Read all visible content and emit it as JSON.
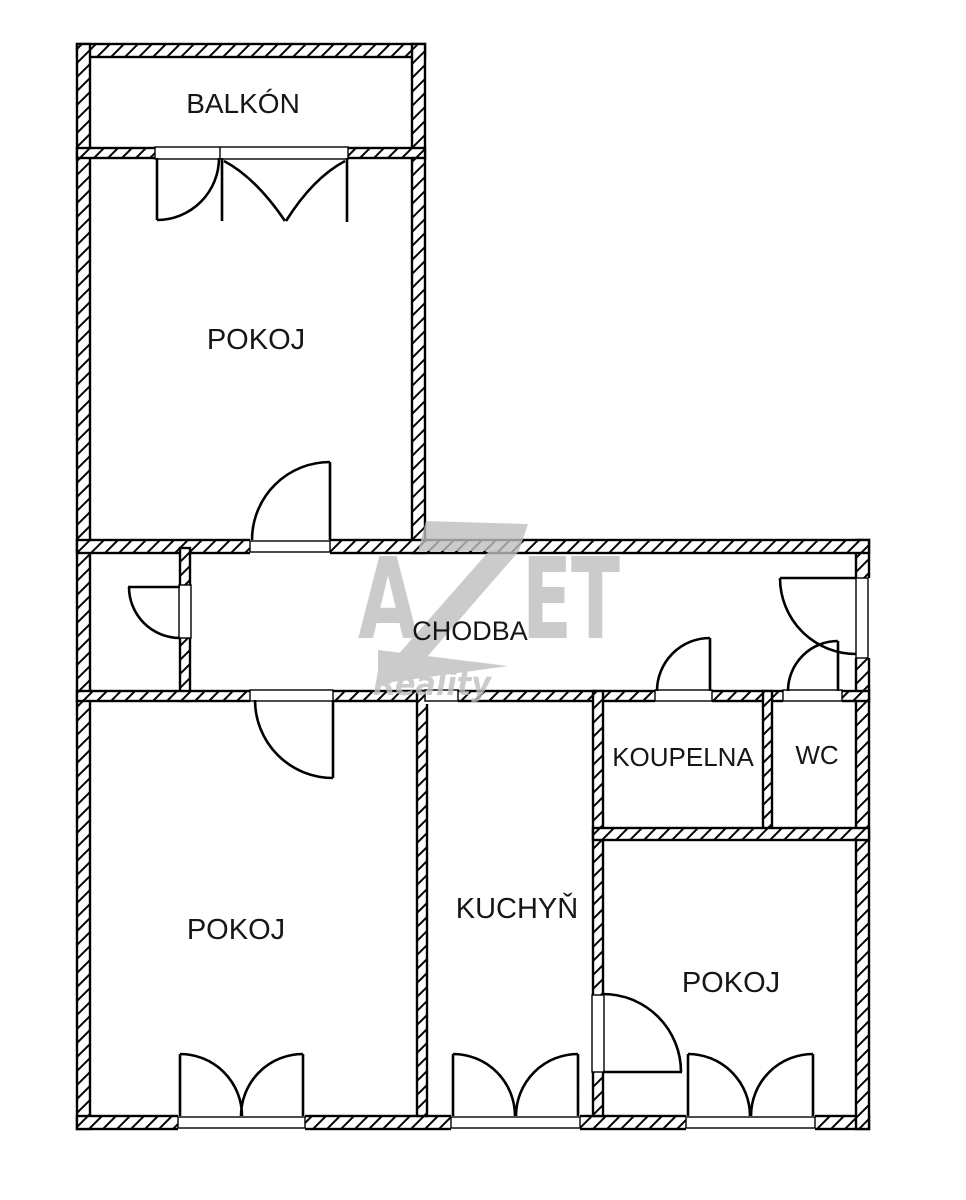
{
  "plan": {
    "title": "Apartment floor plan",
    "rooms": [
      {
        "id": "balkon",
        "label": "BALKÓN"
      },
      {
        "id": "pokoj-top",
        "label": "POKOJ"
      },
      {
        "id": "chodba",
        "label": "CHODBA"
      },
      {
        "id": "koupelna",
        "label": "KOUPELNA"
      },
      {
        "id": "wc",
        "label": "WC"
      },
      {
        "id": "pokoj-left",
        "label": "POKOJ"
      },
      {
        "id": "kuchyn",
        "label": "KUCHYŇ"
      },
      {
        "id": "pokoj-right",
        "label": "POKOJ"
      }
    ]
  },
  "watermark": {
    "letter_a": "A",
    "letter_e": "E",
    "letter_t": "T",
    "subtitle": "Reality",
    "color": "#bfbfbf"
  },
  "colors": {
    "wall_line": "#000000",
    "background": "#ffffff",
    "label_text": "#161616"
  }
}
